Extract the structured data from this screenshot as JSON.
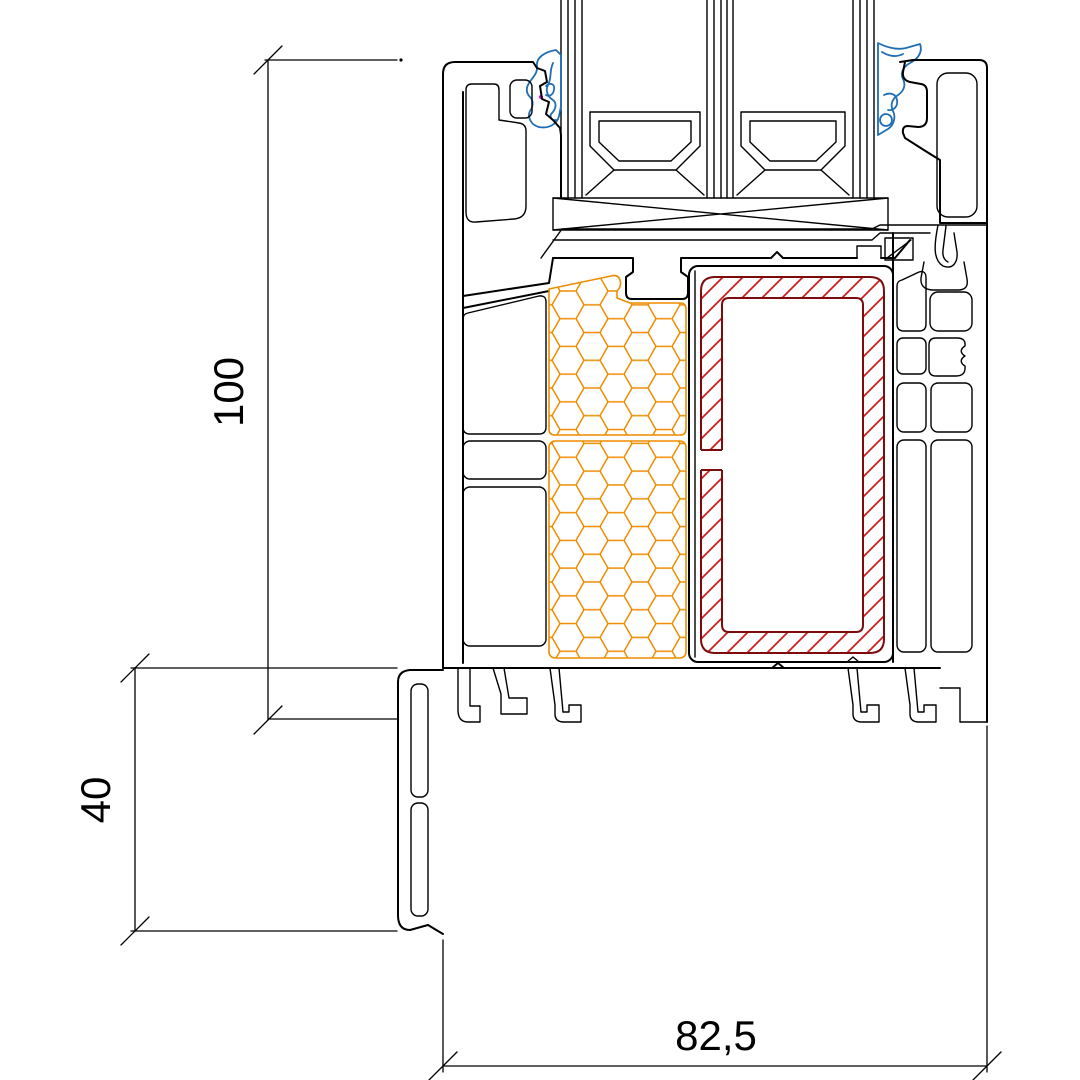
{
  "diagram": {
    "title": "window-sill-profile-cross-section",
    "dimensions": {
      "height_label": "100",
      "extension_height_label": "40",
      "depth_label": "82,5"
    },
    "components": {
      "insulation": "honeycomb-foam-filling",
      "reinforcement": "steel-hollow-section-hatched",
      "gaskets": "glazing-gaskets",
      "glazing": "triple-glass-unit-with-spacers",
      "setting_block": "cross-marked-glazing-block",
      "sill_extension": "bottom-extension-profile"
    },
    "colors": {
      "line": "#000000",
      "gasket": "#1f6eb4",
      "insulation": "#ef8c00",
      "steel_outline": "#7d0d0d",
      "steel_hatch": "#cc2020",
      "node_marker": "#ff00ff",
      "background": "#ffffff"
    }
  }
}
